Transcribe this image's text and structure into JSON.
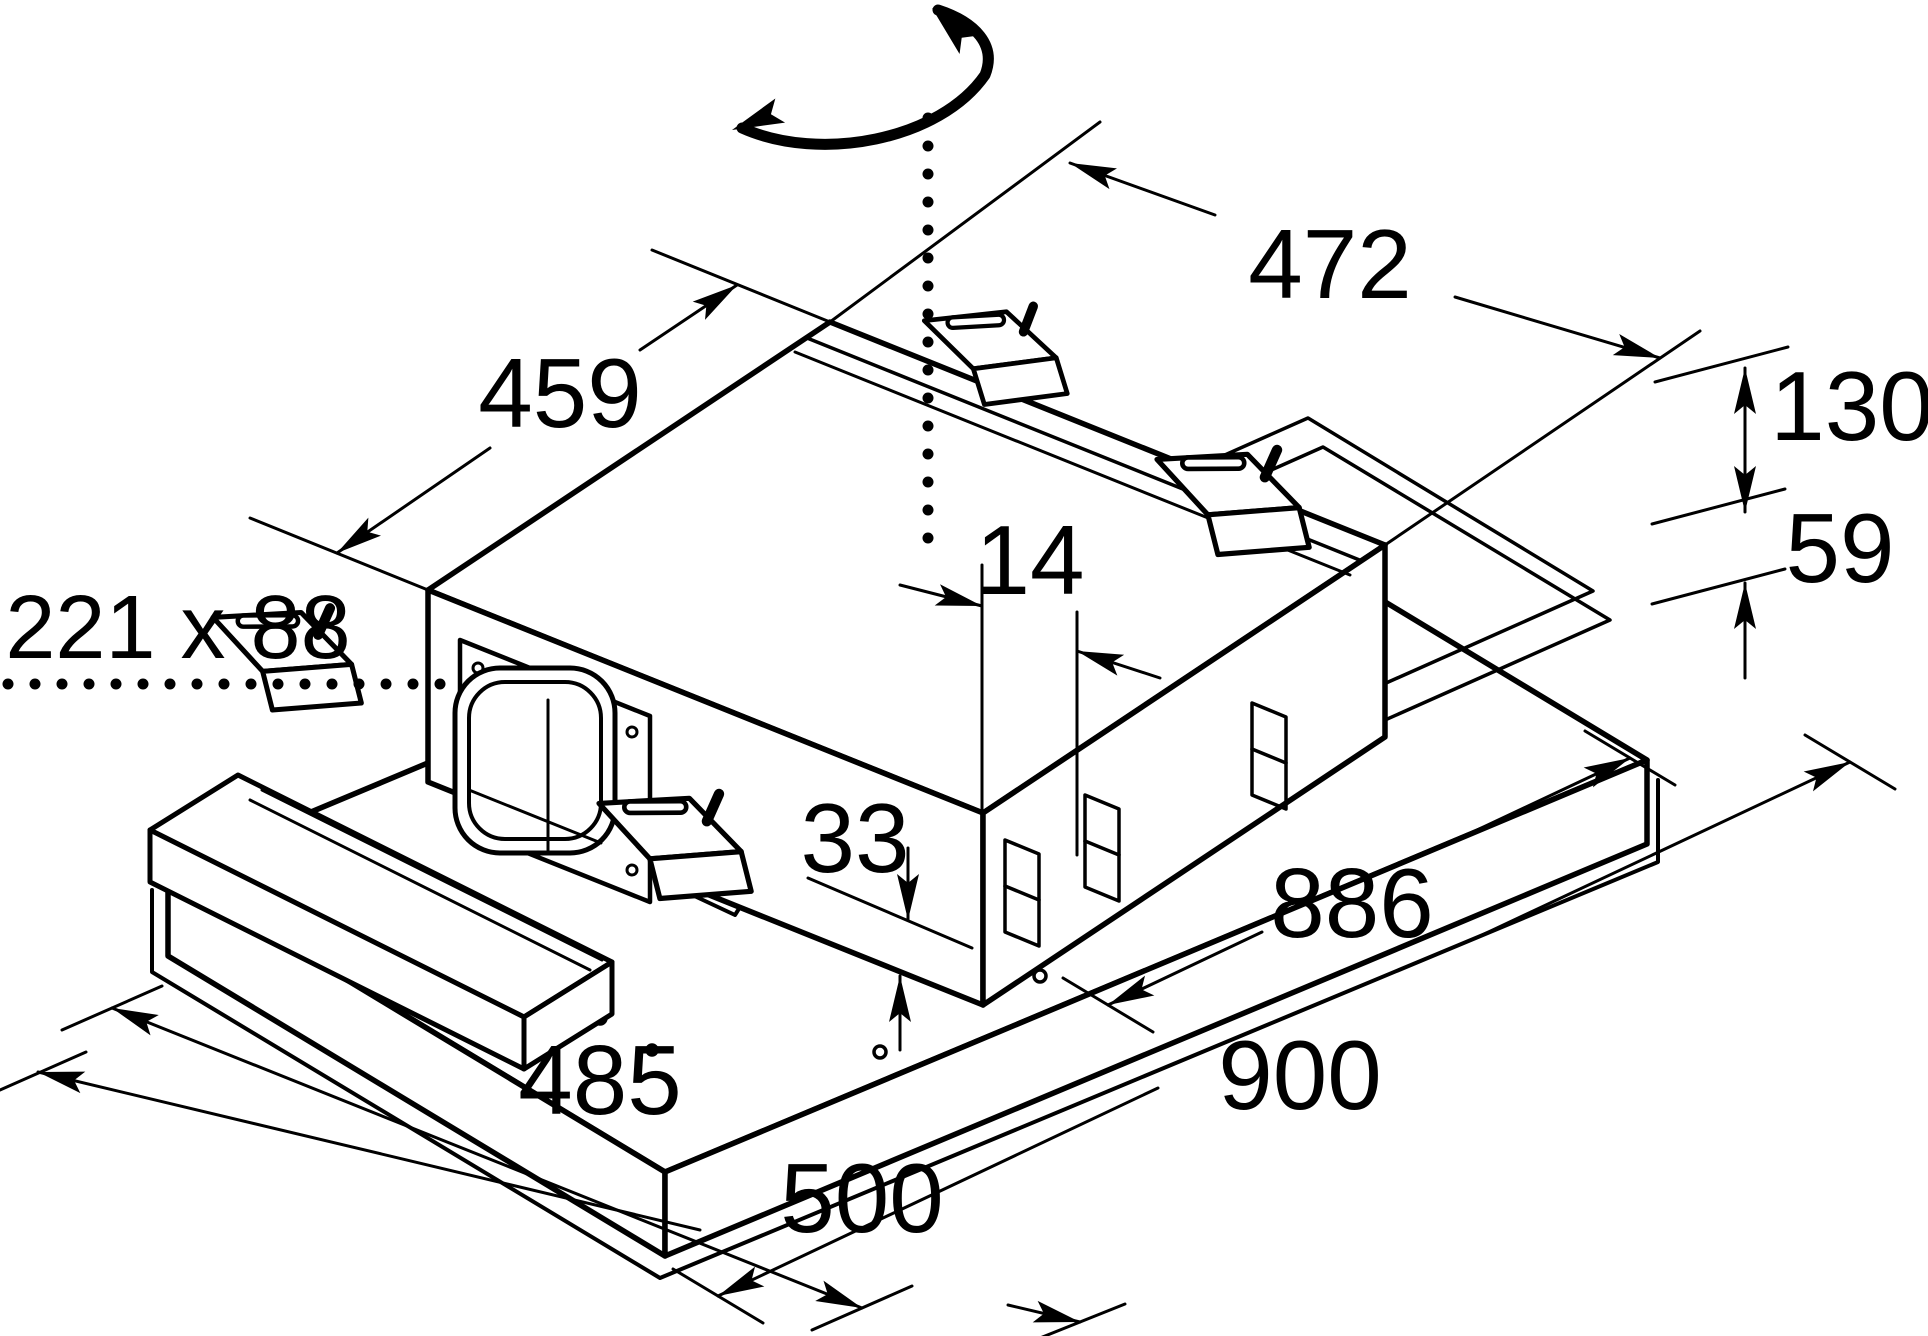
{
  "drawing": {
    "type": "installation-dimension-diagram",
    "subject": "ceiling-extractor-hood-unit",
    "units": "mm",
    "colors": {
      "line": "#000000",
      "background": "#ffffff"
    },
    "dimensions": {
      "top_width": "472",
      "top_depth": "459",
      "housing_height": "130",
      "panel_height": "59",
      "edge_offset": "14",
      "duct_outlet": "221 x 88",
      "bottom_gap": "33",
      "cutout_length": "886",
      "panel_length": "900",
      "cutout_width": "485",
      "panel_width": "500"
    },
    "icons": {
      "rotation": "rotation-arrow",
      "centerline": "dotted-center-line"
    }
  }
}
